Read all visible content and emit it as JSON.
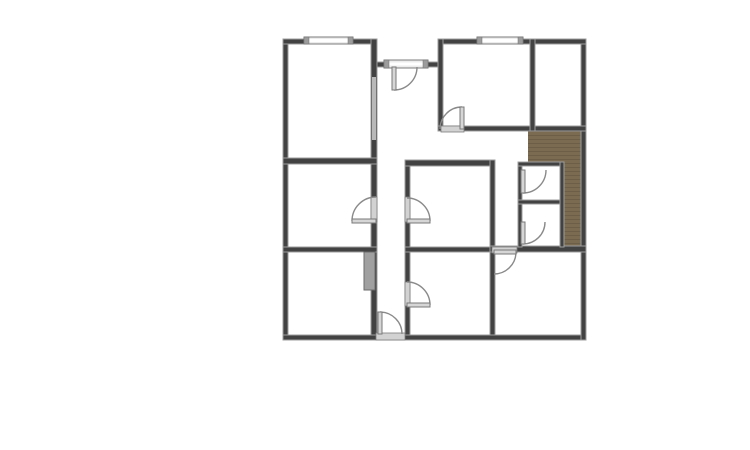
{
  "canvas": {
    "width": 750,
    "height": 450,
    "background": "#ffffff"
  },
  "palette": {
    "wall": "#424242",
    "wall_edge": "#9e9e9e",
    "window_band": "#ececec",
    "window_cap": "#9c9c9c",
    "door_frame": "#d2d2d2",
    "wall_opening": "#b8b8b8",
    "sliding_door": "#a0a0a0",
    "swing_arc": "#8a8a8a",
    "wood_floor": "#7b6b51",
    "wood_floor_line": "#6d5f47"
  },
  "plan": {
    "floors": [
      {
        "name": "wood-floor-upper",
        "x": 528,
        "y": 131,
        "w": 53,
        "h": 32
      },
      {
        "name": "wood-floor-right",
        "x": 564,
        "y": 163,
        "w": 17,
        "h": 84
      }
    ],
    "walls": [
      {
        "name": "wall-outer-left",
        "x": 283,
        "y": 39,
        "w": 5,
        "h": 301
      },
      {
        "name": "wall-outer-bottom",
        "x": 283,
        "y": 335,
        "w": 303,
        "h": 5
      },
      {
        "name": "wall-outer-right",
        "x": 581,
        "y": 39,
        "w": 5,
        "h": 301
      },
      {
        "name": "wall-top-left-block",
        "x": 283,
        "y": 39,
        "w": 94,
        "h": 5
      },
      {
        "name": "wall-top-right-block",
        "x": 438,
        "y": 39,
        "w": 148,
        "h": 5
      },
      {
        "name": "wall-hallway-north",
        "x": 371,
        "y": 62,
        "w": 72,
        "h": 5
      },
      {
        "name": "wall-vertical-left-rooms",
        "x": 371,
        "y": 39,
        "w": 6,
        "h": 296
      },
      {
        "name": "wall-vertical-center-rooms",
        "x": 405,
        "y": 160,
        "w": 5,
        "h": 175
      },
      {
        "name": "wall-topright-room-left",
        "x": 438,
        "y": 39,
        "w": 5,
        "h": 92
      },
      {
        "name": "wall-topright-room-bottom",
        "x": 438,
        "y": 126,
        "w": 148,
        "h": 5
      },
      {
        "name": "wall-narrow-room-left",
        "x": 530,
        "y": 39,
        "w": 5,
        "h": 92
      },
      {
        "name": "wall-topleft-room-bottom",
        "x": 283,
        "y": 158,
        "w": 94,
        "h": 6
      },
      {
        "name": "wall-midcenter-room-top",
        "x": 405,
        "y": 160,
        "w": 89,
        "h": 6
      },
      {
        "name": "wall-vertical-right-rooms",
        "x": 490,
        "y": 160,
        "w": 5,
        "h": 175
      },
      {
        "name": "wall-left-rooms-divider",
        "x": 283,
        "y": 247,
        "w": 94,
        "h": 5
      },
      {
        "name": "wall-center-rooms-divider",
        "x": 405,
        "y": 247,
        "w": 89,
        "h": 5
      },
      {
        "name": "wall-right-rooms-divider",
        "x": 490,
        "y": 246,
        "w": 96,
        "h": 6
      },
      {
        "name": "wall-closet-left",
        "x": 518,
        "y": 162,
        "w": 4,
        "h": 85
      },
      {
        "name": "wall-closet-top",
        "x": 518,
        "y": 162,
        "w": 46,
        "h": 4
      },
      {
        "name": "wall-closet-divider",
        "x": 518,
        "y": 200,
        "w": 46,
        "h": 4
      },
      {
        "name": "wall-closet-right",
        "x": 560,
        "y": 162,
        "w": 4,
        "h": 85
      }
    ],
    "windows": [
      {
        "name": "window-top-left",
        "x": 304,
        "y": 37,
        "w": 49,
        "h": 7
      },
      {
        "name": "window-top-right",
        "x": 477,
        "y": 37,
        "w": 46,
        "h": 7
      },
      {
        "name": "entry-door-frame",
        "x": 384,
        "y": 60,
        "w": 44,
        "h": 8
      }
    ],
    "openings": [
      {
        "name": "wall-opening-topleft-room",
        "x": 372,
        "y": 77,
        "w": 4,
        "h": 63,
        "kind": "light"
      },
      {
        "name": "sliding-door-bottomleft-room",
        "x": 364,
        "y": 252,
        "w": 11,
        "h": 38,
        "kind": "slider"
      },
      {
        "name": "door-frame-leftmiddle-room",
        "x": 371,
        "y": 197,
        "w": 6,
        "h": 25,
        "kind": "frame"
      },
      {
        "name": "door-frame-midcenter-room",
        "x": 405,
        "y": 197,
        "w": 5,
        "h": 25,
        "kind": "frame"
      },
      {
        "name": "door-frame-bottomcenter-room",
        "x": 405,
        "y": 282,
        "w": 5,
        "h": 24,
        "kind": "frame"
      },
      {
        "name": "door-threshold-topright-room",
        "x": 441,
        "y": 126,
        "w": 23,
        "h": 6,
        "kind": "frame"
      },
      {
        "name": "door-frame-bottomright-room",
        "x": 492,
        "y": 247,
        "w": 25,
        "h": 6,
        "kind": "frame"
      },
      {
        "name": "door-threshold-hall",
        "x": 376,
        "y": 333,
        "w": 29,
        "h": 7,
        "kind": "frame"
      }
    ],
    "doors": [
      {
        "name": "door-entry",
        "leaf": [
          394,
          67,
          394,
          90
        ],
        "arc": {
          "from": [
            394,
            90
          ],
          "to": [
            417,
            67
          ],
          "r": 23,
          "sweep": 0
        }
      },
      {
        "name": "door-topright-room",
        "leaf": [
          462,
          107,
          462,
          129
        ],
        "arc": {
          "from": [
            462,
            107
          ],
          "to": [
            440,
            129
          ],
          "r": 22,
          "sweep": 0
        }
      },
      {
        "name": "door-leftmiddle-room",
        "leaf": [
          352,
          221,
          376,
          221
        ],
        "arc": {
          "from": [
            352,
            221
          ],
          "to": [
            376,
            197
          ],
          "r": 24,
          "sweep": 1
        }
      },
      {
        "name": "door-midcenter-room",
        "leaf": [
          407,
          221,
          430,
          221
        ],
        "arc": {
          "from": [
            430,
            221
          ],
          "to": [
            407,
            198
          ],
          "r": 23,
          "sweep": 0
        }
      },
      {
        "name": "door-bottomcenter-room",
        "leaf": [
          407,
          305,
          430,
          305
        ],
        "arc": {
          "from": [
            430,
            305
          ],
          "to": [
            407,
            282
          ],
          "r": 23,
          "sweep": 0
        }
      },
      {
        "name": "door-hall-bottom",
        "leaf": [
          380,
          312,
          380,
          334
        ],
        "arc": {
          "from": [
            380,
            312
          ],
          "to": [
            402,
            334
          ],
          "r": 22,
          "sweep": 1
        }
      },
      {
        "name": "door-bottomright-room",
        "leaf": [
          494,
          252,
          516,
          252
        ],
        "arc": {
          "from": [
            516,
            252
          ],
          "to": [
            494,
            274
          ],
          "r": 22,
          "sweep": 1
        }
      },
      {
        "name": "door-closet-top",
        "leaf": [
          523,
          170,
          523,
          193
        ],
        "arc": {
          "from": [
            523,
            193
          ],
          "to": [
            546,
            170
          ],
          "r": 23,
          "sweep": 0
        }
      },
      {
        "name": "door-closet-bottom",
        "leaf": [
          523,
          222,
          523,
          244
        ],
        "arc": {
          "from": [
            523,
            244
          ],
          "to": [
            545,
            222
          ],
          "r": 22,
          "sweep": 0
        }
      }
    ]
  }
}
